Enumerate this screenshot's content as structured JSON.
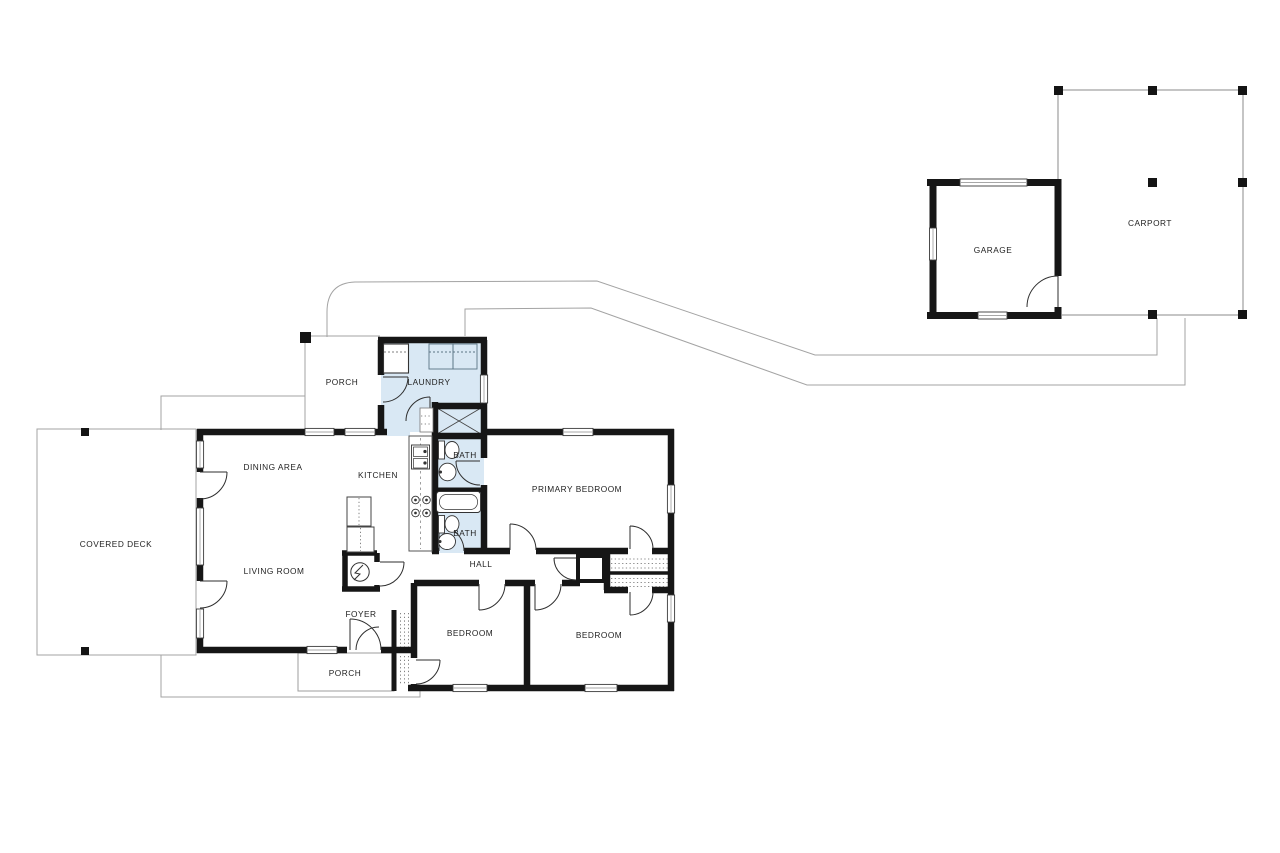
{
  "plan": {
    "labels": {
      "covered_deck": "COVERED DECK",
      "porch_top": "PORCH",
      "porch_bottom": "PORCH",
      "laundry": "LAUNDRY",
      "dining": "DINING AREA",
      "kitchen": "KITCHEN",
      "living": "LIVING ROOM",
      "bath_primary": "BATH",
      "bath_hall": "BATH",
      "primary_bedroom": "PRIMARY BEDROOM",
      "hall": "HALL",
      "foyer": "FOYER",
      "bedroom_left": "BEDROOM",
      "bedroom_right": "BEDROOM",
      "garage": "GARAGE",
      "carport": "CARPORT"
    },
    "icons": {
      "electrical_panel": "lightning-bolt-icon",
      "water_heater": "x-cross-icon"
    }
  },
  "colors": {
    "wall": "#161616",
    "wet_room_fill": "#d9e8f4",
    "site_line": "#a3a3a3",
    "label": "#1f1f1f"
  }
}
